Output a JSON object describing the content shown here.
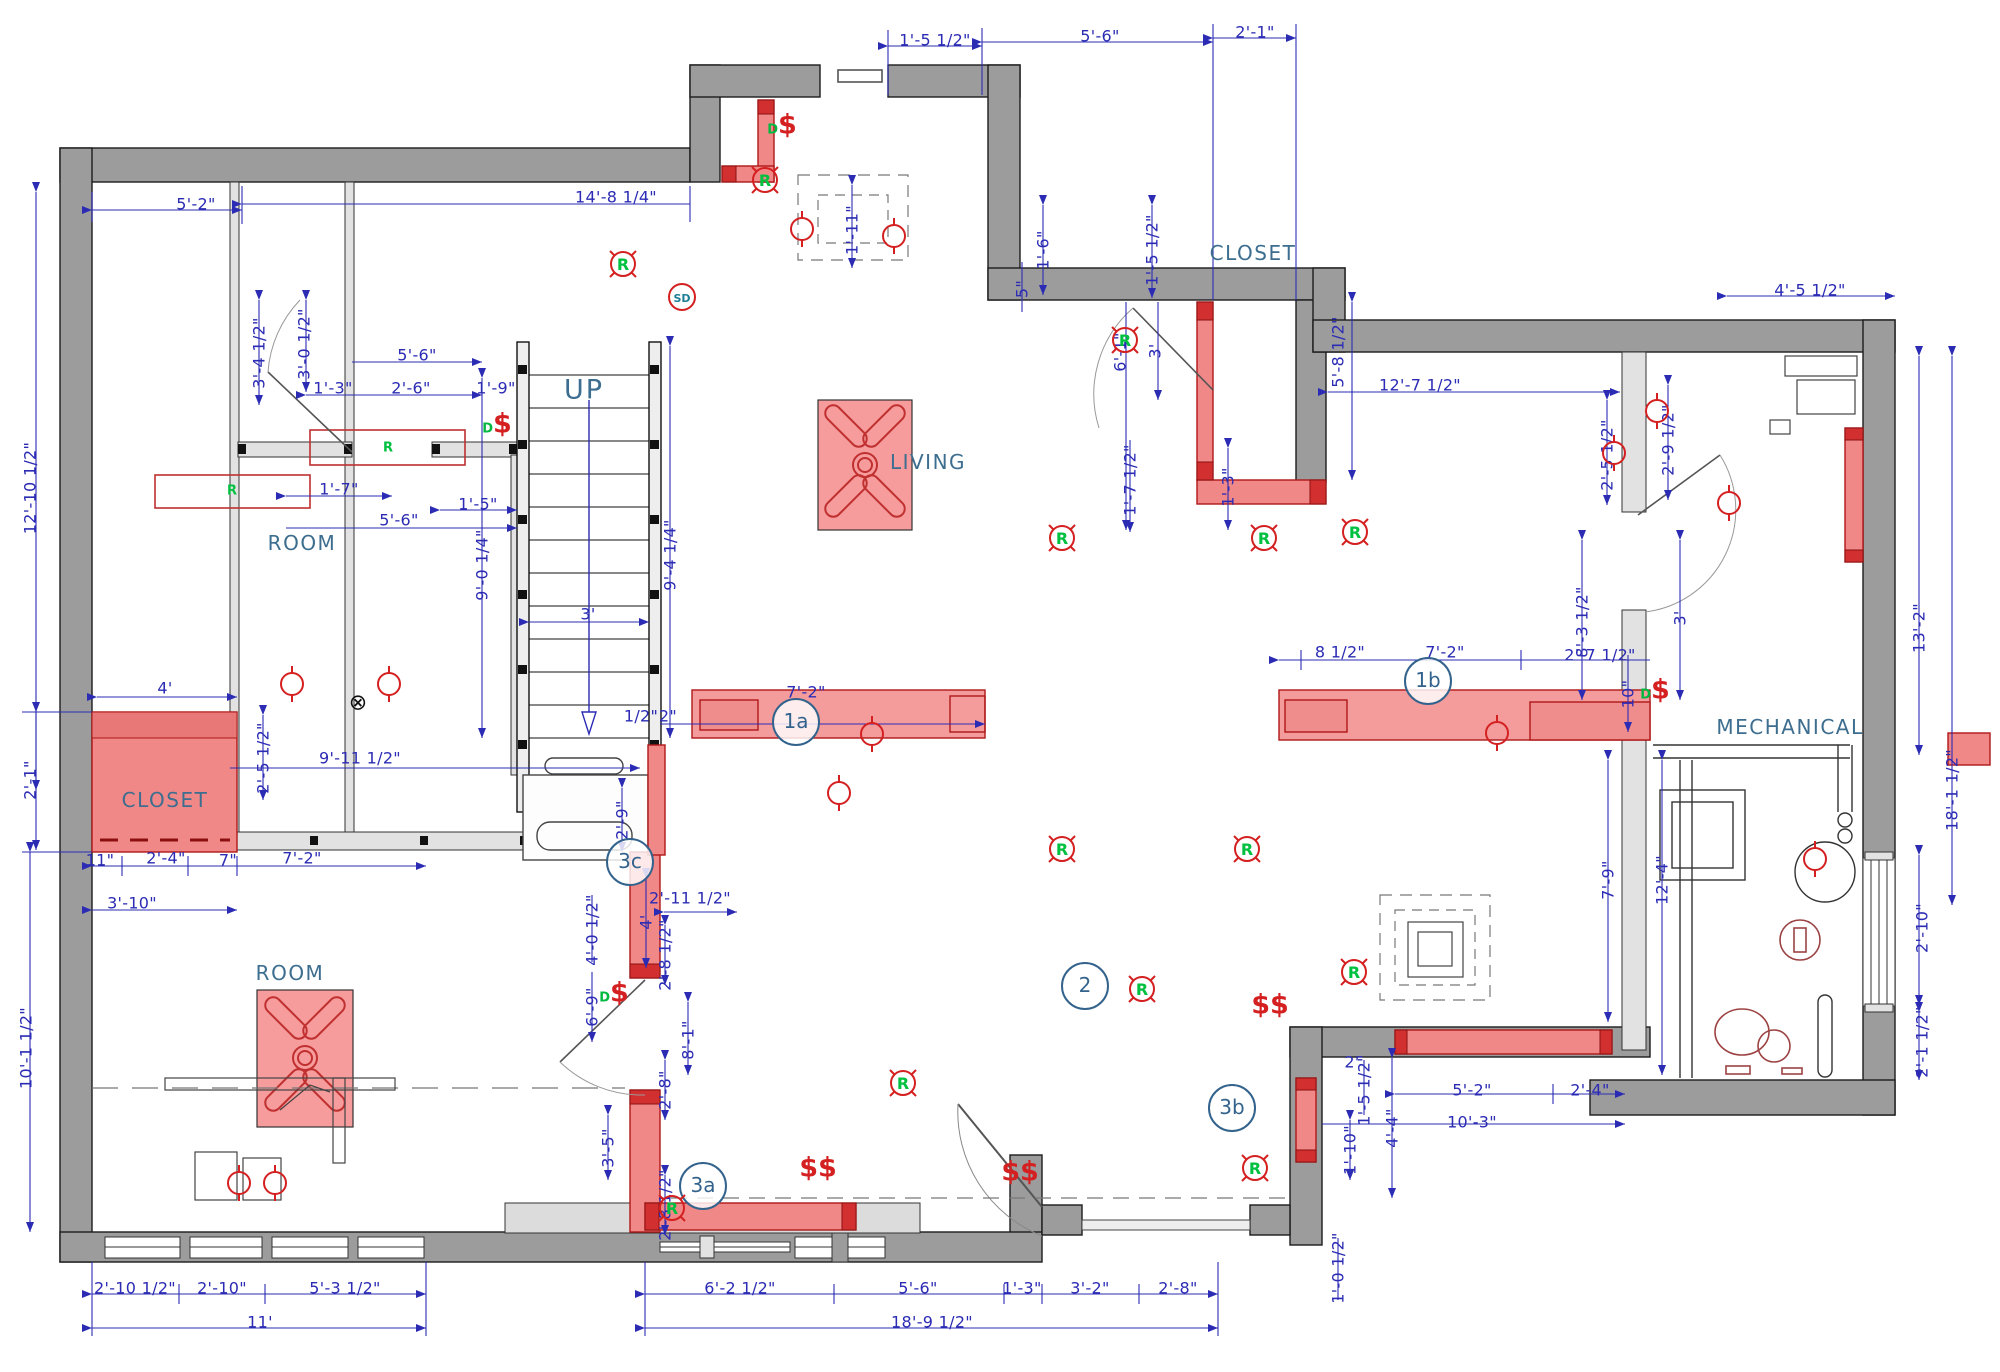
{
  "drawing": {
    "type": "basement electrical / framing floor plan",
    "colors": {
      "wall_gray": "#9c9c9c",
      "wall_light": "#e2e2e2",
      "highlight_pink": "#f08888",
      "highlight_dark": "#d23030",
      "dim_blue": "#2b2bb4",
      "label_teal": "#3d6e8f",
      "symbol_red": "#d42020",
      "symbol_green": "#00b840"
    }
  },
  "rooms": [
    {
      "label": "ROOM",
      "x": 302,
      "y": 543,
      "big": false
    },
    {
      "label": "ROOM",
      "x": 290,
      "y": 973,
      "big": false
    },
    {
      "label": "LIVING",
      "x": 928,
      "y": 462,
      "big": false
    },
    {
      "label": "CLOSET",
      "x": 165,
      "y": 800,
      "big": false
    },
    {
      "label": "CLOSET",
      "x": 1253,
      "y": 253,
      "big": false
    },
    {
      "label": "MECHANICAL",
      "x": 1790,
      "y": 727,
      "big": false
    },
    {
      "label": "UP",
      "x": 584,
      "y": 390,
      "big": true
    }
  ],
  "refs": [
    {
      "id": "1a",
      "x": 796,
      "y": 722
    },
    {
      "id": "1b",
      "x": 1428,
      "y": 681
    },
    {
      "id": "2",
      "x": 1085,
      "y": 986
    },
    {
      "id": "3a",
      "x": 703,
      "y": 1186
    },
    {
      "id": "3b",
      "x": 1232,
      "y": 1108
    },
    {
      "id": "3c",
      "x": 630,
      "y": 862
    }
  ],
  "dimensions": [
    {
      "text": "5'-2\"",
      "x": 196,
      "y": 204,
      "rot": "h"
    },
    {
      "text": "14'-8 1/4\"",
      "x": 616,
      "y": 197,
      "rot": "h"
    },
    {
      "text": "1'-5 1/2\"",
      "x": 935,
      "y": 40,
      "rot": "h"
    },
    {
      "text": "5'-6\"",
      "x": 1100,
      "y": 36,
      "rot": "h"
    },
    {
      "text": "2'-1\"",
      "x": 1255,
      "y": 32,
      "rot": "h"
    },
    {
      "text": "3'-4 1/2\"",
      "x": 259,
      "y": 353,
      "rot": "v"
    },
    {
      "text": "3'-0 1/2\"",
      "x": 304,
      "y": 344,
      "rot": "v"
    },
    {
      "text": "1'-3\"",
      "x": 333,
      "y": 388,
      "rot": "h"
    },
    {
      "text": "2'-6\"",
      "x": 411,
      "y": 388,
      "rot": "h"
    },
    {
      "text": "5'-6\"",
      "x": 417,
      "y": 355,
      "rot": "h"
    },
    {
      "text": "1'-9\"",
      "x": 496,
      "y": 388,
      "rot": "h"
    },
    {
      "text": "1'-7\"",
      "x": 339,
      "y": 489,
      "rot": "h"
    },
    {
      "text": "5'-6\"",
      "x": 399,
      "y": 520,
      "rot": "h"
    },
    {
      "text": "1'-5\"",
      "x": 478,
      "y": 504,
      "rot": "h"
    },
    {
      "text": "12'-10 1/2\"",
      "x": 30,
      "y": 488,
      "rot": "v"
    },
    {
      "text": "2'-1\"",
      "x": 30,
      "y": 780,
      "rot": "v"
    },
    {
      "text": "10'-1 1/2\"",
      "x": 26,
      "y": 1048,
      "rot": "v"
    },
    {
      "text": "2'-5 1/2\"",
      "x": 263,
      "y": 758,
      "rot": "v"
    },
    {
      "text": "4'",
      "x": 165,
      "y": 688,
      "rot": "h"
    },
    {
      "text": "9'-11 1/2\"",
      "x": 360,
      "y": 758,
      "rot": "h"
    },
    {
      "text": "11\"",
      "x": 100,
      "y": 860,
      "rot": "h"
    },
    {
      "text": "2'-4\"",
      "x": 166,
      "y": 858,
      "rot": "h"
    },
    {
      "text": "7\"",
      "x": 228,
      "y": 860,
      "rot": "h"
    },
    {
      "text": "3'-10\"",
      "x": 132,
      "y": 903,
      "rot": "h"
    },
    {
      "text": "7'-2\"",
      "x": 302,
      "y": 858,
      "rot": "h"
    },
    {
      "text": "9'-0 1/4\"",
      "x": 482,
      "y": 565,
      "rot": "v"
    },
    {
      "text": "9'-4 1/4\"",
      "x": 670,
      "y": 555,
      "rot": "v"
    },
    {
      "text": "3'",
      "x": 588,
      "y": 614,
      "rot": "h"
    },
    {
      "text": "1/2\"",
      "x": 641,
      "y": 716,
      "rot": "h"
    },
    {
      "text": "2\"",
      "x": 668,
      "y": 716,
      "rot": "h"
    },
    {
      "text": "7'-2\"",
      "x": 806,
      "y": 692,
      "rot": "h"
    },
    {
      "text": "2'-9\"",
      "x": 622,
      "y": 820,
      "rot": "v"
    },
    {
      "text": "4'",
      "x": 646,
      "y": 922,
      "rot": "v"
    },
    {
      "text": "2'-11 1/2\"",
      "x": 690,
      "y": 898,
      "rot": "h"
    },
    {
      "text": "4'-0 1/2\"",
      "x": 592,
      "y": 930,
      "rot": "v"
    },
    {
      "text": "6'-9\"",
      "x": 592,
      "y": 1007,
      "rot": "v"
    },
    {
      "text": "2'-8 1/2\"",
      "x": 665,
      "y": 955,
      "rot": "v"
    },
    {
      "text": "2'-8\"",
      "x": 665,
      "y": 1090,
      "rot": "v"
    },
    {
      "text": "8'-1\"",
      "x": 688,
      "y": 1040,
      "rot": "v"
    },
    {
      "text": "2'-8 1/2\"",
      "x": 665,
      "y": 1205,
      "rot": "v"
    },
    {
      "text": "3'-5\"",
      "x": 608,
      "y": 1148,
      "rot": "v"
    },
    {
      "text": "2'-10 1/2\"",
      "x": 135,
      "y": 1288,
      "rot": "h"
    },
    {
      "text": "2'-10\"",
      "x": 222,
      "y": 1288,
      "rot": "h"
    },
    {
      "text": "5'-3 1/2\"",
      "x": 345,
      "y": 1288,
      "rot": "h"
    },
    {
      "text": "11'",
      "x": 260,
      "y": 1322,
      "rot": "h"
    },
    {
      "text": "6'-2 1/2\"",
      "x": 740,
      "y": 1288,
      "rot": "h"
    },
    {
      "text": "5'-6\"",
      "x": 918,
      "y": 1288,
      "rot": "h"
    },
    {
      "text": "1'-3\"",
      "x": 1022,
      "y": 1288,
      "rot": "h"
    },
    {
      "text": "3'-2\"",
      "x": 1090,
      "y": 1288,
      "rot": "h"
    },
    {
      "text": "2'-8\"",
      "x": 1178,
      "y": 1288,
      "rot": "h"
    },
    {
      "text": "18'-9 1/2\"",
      "x": 932,
      "y": 1322,
      "rot": "h"
    },
    {
      "text": "1'-0 1/2\"",
      "x": 1338,
      "y": 1268,
      "rot": "v"
    },
    {
      "text": "1'-11\"",
      "x": 852,
      "y": 230,
      "rot": "v"
    },
    {
      "text": "1'-6\"",
      "x": 1043,
      "y": 250,
      "rot": "v"
    },
    {
      "text": "5\"",
      "x": 1022,
      "y": 289,
      "rot": "v"
    },
    {
      "text": "1'-5 1/2\"",
      "x": 1152,
      "y": 250,
      "rot": "v"
    },
    {
      "text": "6'-1\"",
      "x": 1120,
      "y": 352,
      "rot": "v"
    },
    {
      "text": "3'",
      "x": 1155,
      "y": 351,
      "rot": "v"
    },
    {
      "text": "1'-7 1/2\"",
      "x": 1130,
      "y": 480,
      "rot": "v"
    },
    {
      "text": "1'-3\"",
      "x": 1228,
      "y": 487,
      "rot": "v"
    },
    {
      "text": "5'-8 1/2\"",
      "x": 1338,
      "y": 352,
      "rot": "v"
    },
    {
      "text": "4'-5 1/2\"",
      "x": 1810,
      "y": 290,
      "rot": "h"
    },
    {
      "text": "12'-7 1/2\"",
      "x": 1420,
      "y": 385,
      "rot": "h"
    },
    {
      "text": "2'-5 1/2\"",
      "x": 1607,
      "y": 455,
      "rot": "v"
    },
    {
      "text": "2'-9 1/2\"",
      "x": 1668,
      "y": 440,
      "rot": "v"
    },
    {
      "text": "8'-3 1/2\"",
      "x": 1582,
      "y": 622,
      "rot": "v"
    },
    {
      "text": "3'",
      "x": 1680,
      "y": 618,
      "rot": "v"
    },
    {
      "text": "13'-2\"",
      "x": 1919,
      "y": 628,
      "rot": "v"
    },
    {
      "text": "18'-1 1/2\"",
      "x": 1952,
      "y": 790,
      "rot": "v"
    },
    {
      "text": "10\"",
      "x": 1628,
      "y": 694,
      "rot": "v"
    },
    {
      "text": "2'-7 1/2\"",
      "x": 1600,
      "y": 655,
      "rot": "h"
    },
    {
      "text": "8 1/2\"",
      "x": 1340,
      "y": 652,
      "rot": "h"
    },
    {
      "text": "7'-2\"",
      "x": 1445,
      "y": 652,
      "rot": "h"
    },
    {
      "text": "12'-4\"",
      "x": 1662,
      "y": 880,
      "rot": "v"
    },
    {
      "text": "7'-9\"",
      "x": 1608,
      "y": 880,
      "rot": "v"
    },
    {
      "text": "2'-10\"",
      "x": 1922,
      "y": 928,
      "rot": "v"
    },
    {
      "text": "2'-1 1/2\"",
      "x": 1922,
      "y": 1042,
      "rot": "v"
    },
    {
      "text": "5'-2\"",
      "x": 1472,
      "y": 1090,
      "rot": "h"
    },
    {
      "text": "2'-4\"",
      "x": 1590,
      "y": 1090,
      "rot": "h"
    },
    {
      "text": "10'-3\"",
      "x": 1472,
      "y": 1122,
      "rot": "h"
    },
    {
      "text": "2'",
      "x": 1352,
      "y": 1062,
      "rot": "h"
    },
    {
      "text": "1'-5 1/2\"",
      "x": 1364,
      "y": 1090,
      "rot": "v"
    },
    {
      "text": "1'-10\"",
      "x": 1350,
      "y": 1150,
      "rot": "v"
    },
    {
      "text": "4'-4\"",
      "x": 1392,
      "y": 1128,
      "rot": "v"
    }
  ],
  "symbols": {
    "recessed_glyph": "R",
    "smoke_glyph": "SD",
    "switch_glyph": "$",
    "switch_double_glyph": "$$",
    "switch_sub": "D",
    "cross_glyph": "⊗",
    "recessed_lights": [
      {
        "x": 603,
        "y": 244
      },
      {
        "x": 745,
        "y": 160
      },
      {
        "x": 1105,
        "y": 320
      },
      {
        "x": 1042,
        "y": 518
      },
      {
        "x": 1244,
        "y": 518
      },
      {
        "x": 1335,
        "y": 512
      },
      {
        "x": 1042,
        "y": 829
      },
      {
        "x": 1227,
        "y": 829
      },
      {
        "x": 1122,
        "y": 969
      },
      {
        "x": 883,
        "y": 1063
      },
      {
        "x": 652,
        "y": 1188
      },
      {
        "x": 1235,
        "y": 1148
      },
      {
        "x": 1334,
        "y": 952
      }
    ],
    "pendant_lights": [
      {
        "x": 275,
        "y": 663
      },
      {
        "x": 372,
        "y": 663
      },
      {
        "x": 855,
        "y": 713
      },
      {
        "x": 822,
        "y": 772
      },
      {
        "x": 1480,
        "y": 712
      },
      {
        "x": 1597,
        "y": 432
      },
      {
        "x": 1640,
        "y": 390
      },
      {
        "x": 1712,
        "y": 482
      },
      {
        "x": 1798,
        "y": 838
      },
      {
        "x": 222,
        "y": 1162
      },
      {
        "x": 258,
        "y": 1162
      },
      {
        "x": 877,
        "y": 215
      },
      {
        "x": 785,
        "y": 208
      }
    ],
    "switches_d": [
      {
        "x": 497,
        "y": 424
      },
      {
        "x": 782,
        "y": 125
      },
      {
        "x": 1655,
        "y": 690
      },
      {
        "x": 614,
        "y": 993
      }
    ],
    "switches_double": [
      {
        "x": 818,
        "y": 1168
      },
      {
        "x": 1020,
        "y": 1172
      },
      {
        "x": 1270,
        "y": 1005
      }
    ],
    "smoke_detectors": [
      {
        "x": 665,
        "y": 280
      }
    ],
    "cross_marks": [
      {
        "x": 358,
        "y": 703
      }
    ],
    "fixture_tags": [
      {
        "x": 388,
        "y": 448
      },
      {
        "x": 232,
        "y": 491
      }
    ]
  }
}
